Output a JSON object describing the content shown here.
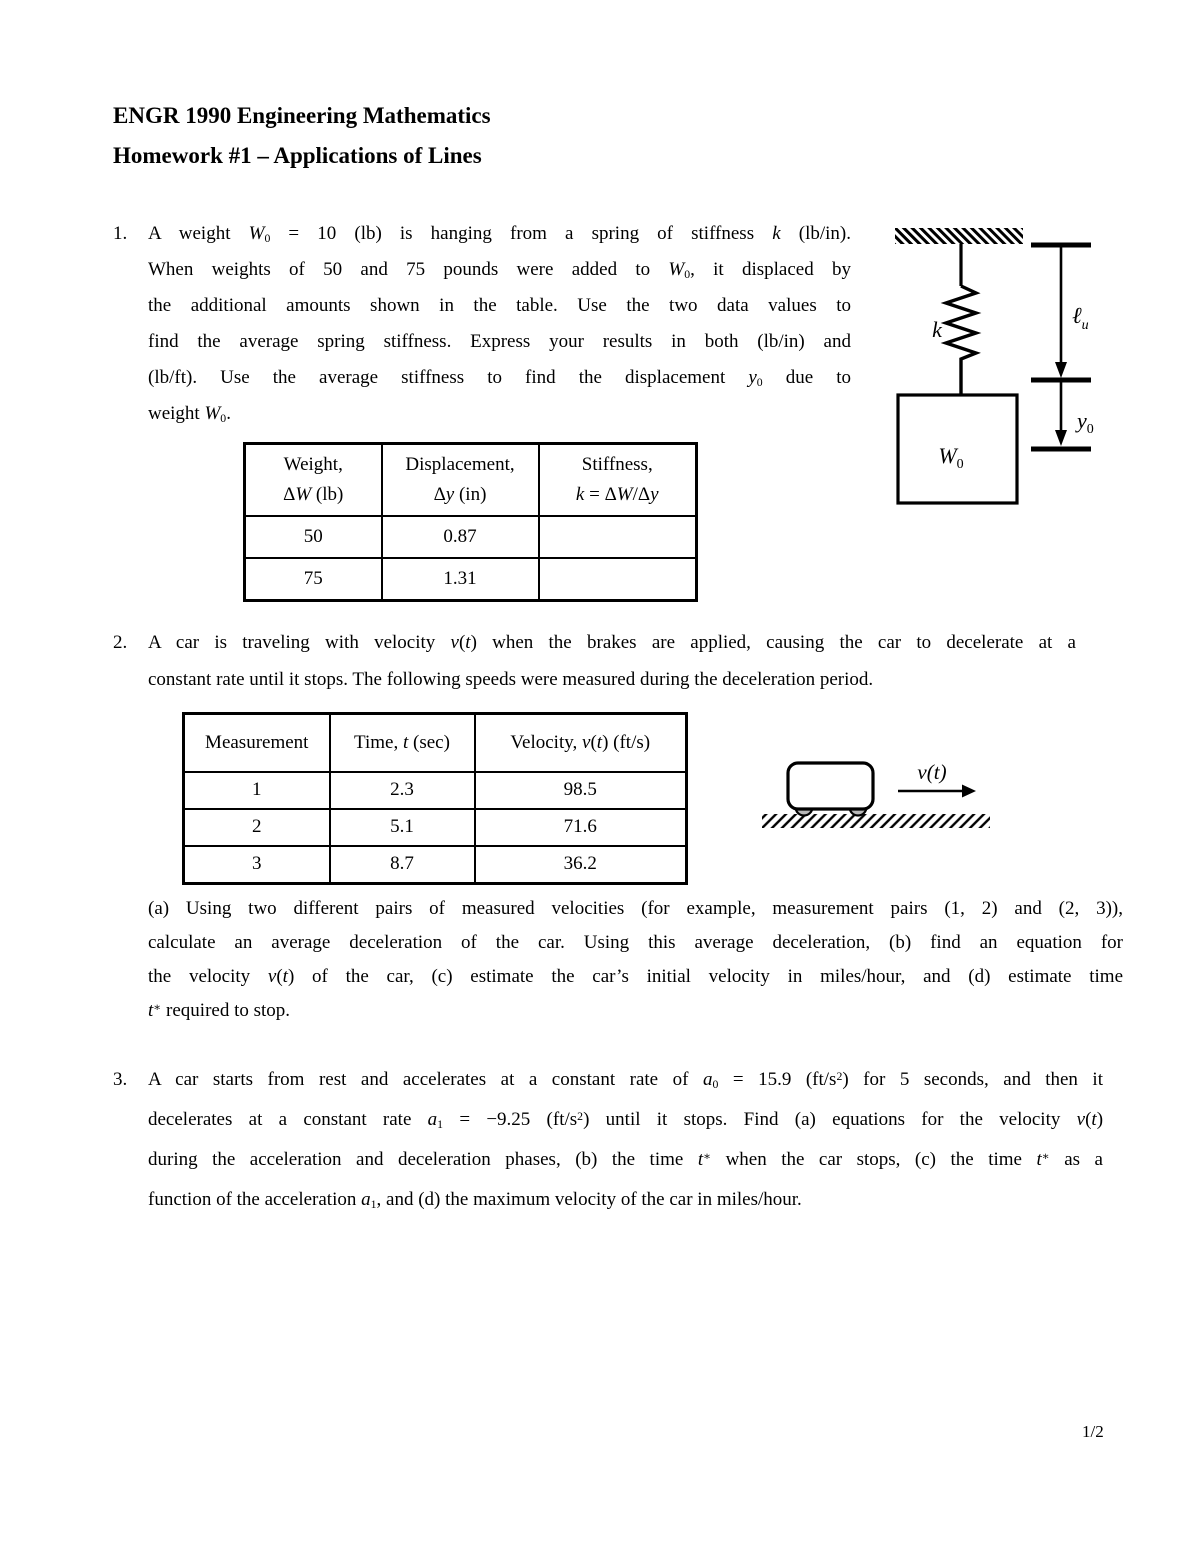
{
  "header": {
    "course_title": "ENGR 1990 Engineering Mathematics",
    "assignment_title": "Homework #1 – Applications of Lines"
  },
  "problem1": {
    "number": "1.",
    "lines": [
      "A weight *W*~0~ = 10 (lb) is hanging from a spring of stiffness *k* (lb/in).",
      "When weights of 50 and 75 pounds were added to *W*~0~, it displaced by",
      "the additional amounts shown in the table. Use the two data values to",
      "find the average spring stiffness. Express your results in both (lb/in) and",
      "(lb/ft). Use the average stiffness to find the displacement *y*~0~ due to",
      "weight *W*~0~."
    ],
    "table": {
      "headers": [
        "Weight,\nΔ*W* (lb)",
        "Displacement,\nΔ*y* (in)",
        "Stiffness,\n*k* = Δ*W*/Δ*y*"
      ],
      "rows": [
        [
          "50",
          "0.87",
          ""
        ],
        [
          "75",
          "1.31",
          ""
        ]
      ]
    },
    "diagram": {
      "spring_stiffness_label": "k",
      "weight_label_base": "W",
      "weight_label_sub": "0",
      "unstretched_length_base": "ℓ",
      "unstretched_length_sub": "u",
      "stretch_label_base": "y",
      "stretch_label_sub": "0"
    }
  },
  "problem2": {
    "number": "2.",
    "lines": [
      "A car is traveling with velocity *v*(*t*) when the brakes are applied, causing the car to decelerate at a",
      "constant rate until it stops. The following speeds were measured during the deceleration period."
    ],
    "table": {
      "headers": [
        "Measurement",
        "Time, *t* (sec)",
        "Velocity, *v*(*t*) (ft/s)"
      ],
      "rows": [
        [
          "1",
          "2.3",
          "98.5"
        ],
        [
          "2",
          "5.1",
          "71.6"
        ],
        [
          "3",
          "8.7",
          "36.2"
        ]
      ]
    },
    "diagram": {
      "velocity_label": "v(t)",
      "wheel_color": "#b8b8b8"
    },
    "subquestion_lines": [
      "(a) Using two different pairs of measured velocities (for example, measurement pairs (1, 2) and (2, 3)),",
      "calculate an average deceleration of the car. Using this average deceleration, (b) find an equation for",
      "the velocity *v*(*t*) of the car, (c) estimate the car’s initial velocity in miles/hour, and (d) estimate time",
      "*t*^∗^ required to stop."
    ]
  },
  "problem3": {
    "number": "3.",
    "lines": [
      "A car starts from rest and accelerates at a constant rate of *a*~0~ = 15.9 (ft/s^2^) for 5 seconds, and then it",
      "decelerates at a constant rate *a*~1~ = −9.25 (ft/s^2^) until it stops. Find (a) equations for the velocity *v*(*t*)",
      "during the acceleration and deceleration phases, (b) the time *t*^∗^ when the car stops, (c) the time *t*^∗^ as a",
      "function of the acceleration *a*~1~, and (d) the maximum velocity of the car in miles/hour."
    ]
  },
  "footer": {
    "page_number": "1/2"
  }
}
